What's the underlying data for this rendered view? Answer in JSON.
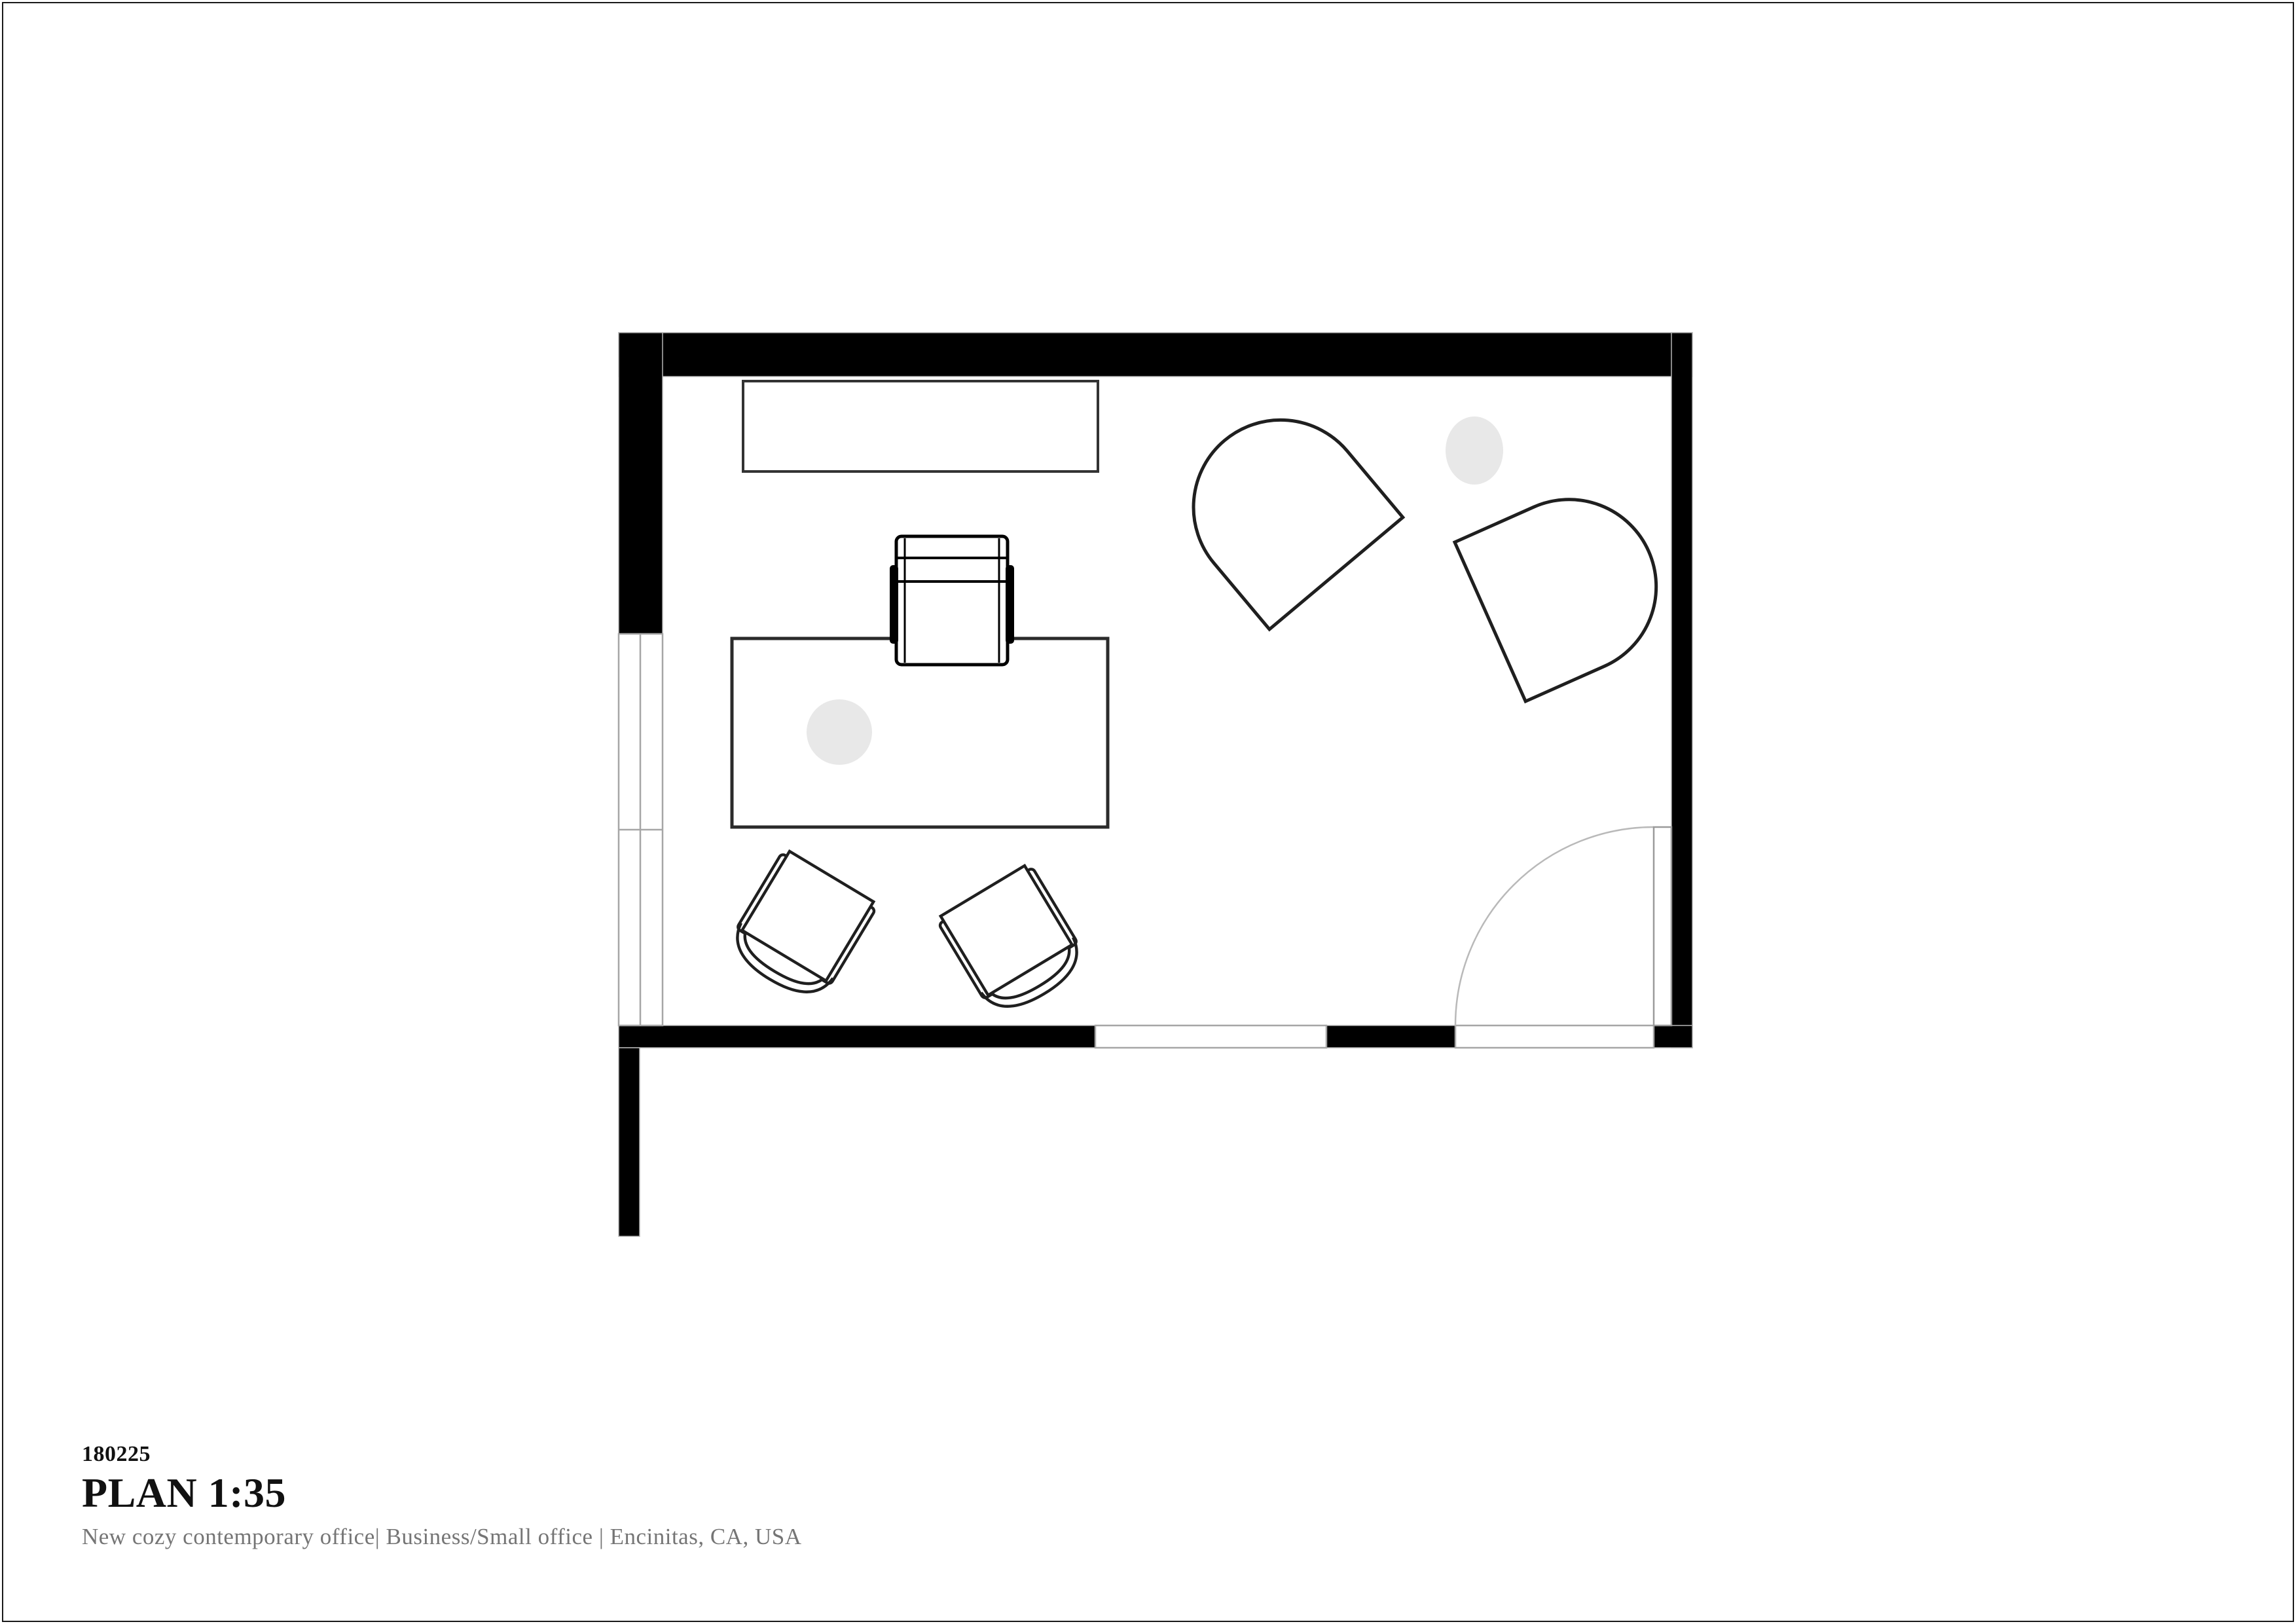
{
  "sheet": {
    "project_number": "180225",
    "plan_title": "PLAN 1:35",
    "subtitle": "New cozy contemporary office|  Business/Small office  |  Encinitas, CA, USA"
  },
  "colors": {
    "background": "#ffffff",
    "page_border": "#1a1a1a",
    "wall": "#000000",
    "wall_edge": "#b5b5b5",
    "window_line": "#a6a6a6",
    "door_line": "#9a9a9a",
    "door_arc": "#b9b9b9",
    "furniture_line": "#1f1f1f",
    "desk_line": "#2b2b2b",
    "credenza_line": "#333333",
    "plant_fill": "#e8e8e8",
    "title_text": "#111111",
    "subtitle_text": "#757575"
  },
  "drawing": {
    "type": "floor-plan",
    "furniture": [
      "credenza",
      "desk",
      "office-chair",
      "visitor-chair",
      "visitor-chair",
      "lounge-armchair",
      "lounge-armchair",
      "desk-plant",
      "floor-plant"
    ],
    "openings": [
      "double-window-left",
      "window-bottom",
      "swing-door-bottom-right"
    ]
  }
}
